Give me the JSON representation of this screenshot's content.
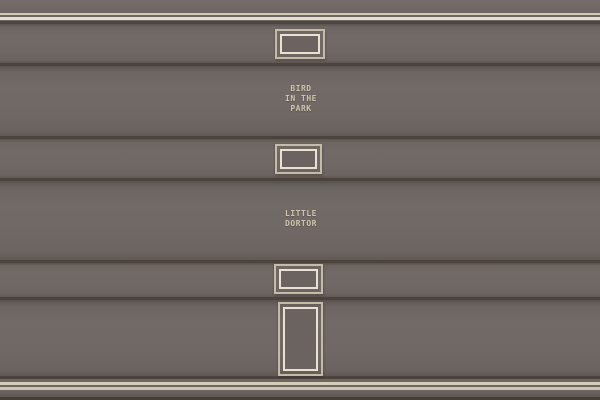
{
  "facade": {
    "wall_color": "#6e6662",
    "separator_color": "#4c433d",
    "trim_cream_color": "#d2c8b6",
    "trim_light_color": "#e7dfce",
    "frame_outer_color": "#c5bba9",
    "frame_inner_color": "#e9e2d2",
    "sign_text_color": "#cec3ac",
    "bottom_band_color": "#433d38"
  },
  "signs": {
    "bird_in_the_park": {
      "line1": "BIRD",
      "line2": "IN THE",
      "line3": "PARK"
    },
    "little_dortor": {
      "line1": "LITTLE",
      "line2": "DORTOR"
    }
  },
  "openings": [
    {
      "name": "window-top",
      "shape": "rectangle"
    },
    {
      "name": "window-middle",
      "shape": "rectangle"
    },
    {
      "name": "window-lower",
      "shape": "rectangle"
    },
    {
      "name": "door",
      "shape": "tall-rectangle"
    }
  ]
}
